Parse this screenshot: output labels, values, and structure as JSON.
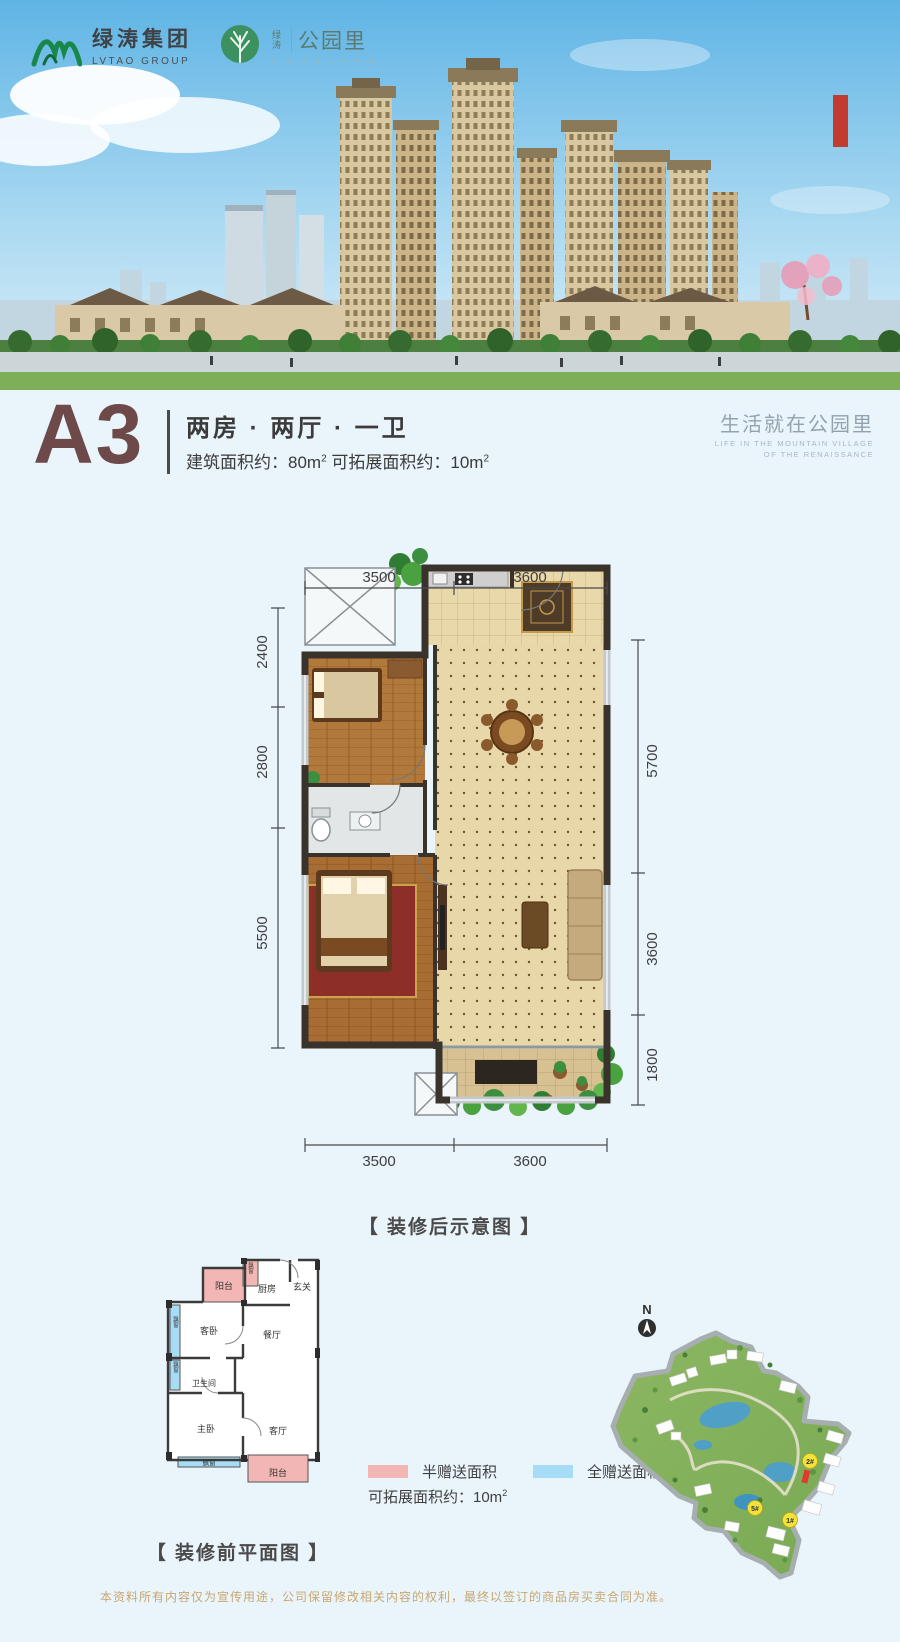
{
  "brand": {
    "logo1": {
      "cn": "绿涛集团",
      "en": "LVTAO GROUP"
    },
    "logo2": {
      "pre": "绿涛",
      "cn": "公园里",
      "en": "P A R K L I F E"
    }
  },
  "title": {
    "unit": "A3",
    "layout": "两房 · 两厅 · 一卫",
    "area_p1": "建筑面积约：80m",
    "area_s1": "2",
    "area_p2": " 可拓展面积约：10m",
    "area_s2": "2",
    "slogan_cn": "生活就在公园里",
    "slogan_en1": "LIFE IN THE MOUNTAIN VILLAGE",
    "slogan_en2": "OF THE RENAISSANCE"
  },
  "decorated_plan": {
    "caption": "【 装修后示意图 】",
    "dims": {
      "top": [
        "3500",
        "3600"
      ],
      "bottom": [
        "3500",
        "3600"
      ],
      "left": [
        "2400",
        "2800",
        "5500"
      ],
      "right": [
        "5700",
        "3600",
        "1800"
      ]
    }
  },
  "plain_plan": {
    "caption": "【 装修前平面图 】",
    "rooms": {
      "balcony_top": "阳台",
      "bay_small": "飘窗",
      "kitchen": "厨房",
      "foyer": "玄关",
      "guest_bedroom": "客卧",
      "dining": "餐厅",
      "bathroom": "卫生间",
      "master_bedroom": "主卧",
      "living": "客厅",
      "balcony_bottom": "阳台",
      "bay_left_1": "飘窗",
      "bay_left_2": "飘窗",
      "bay_bottom": "飘窗"
    }
  },
  "legend": {
    "half_label": "半赠送面积",
    "full_label": "全赠送面积",
    "half_color": "#f2b7b5",
    "full_color": "#a6dcf5",
    "expand_p": "可拓展面积约：10m",
    "expand_s": "2"
  },
  "siteplan": {
    "north": "N",
    "marker1": "2#",
    "marker2": "5#",
    "marker3": "1#"
  },
  "disclaimer": "本资料所有内容仅为宣传用途，公司保留修改相关内容的权利，最终以签订的商品房买卖合同为准。"
}
